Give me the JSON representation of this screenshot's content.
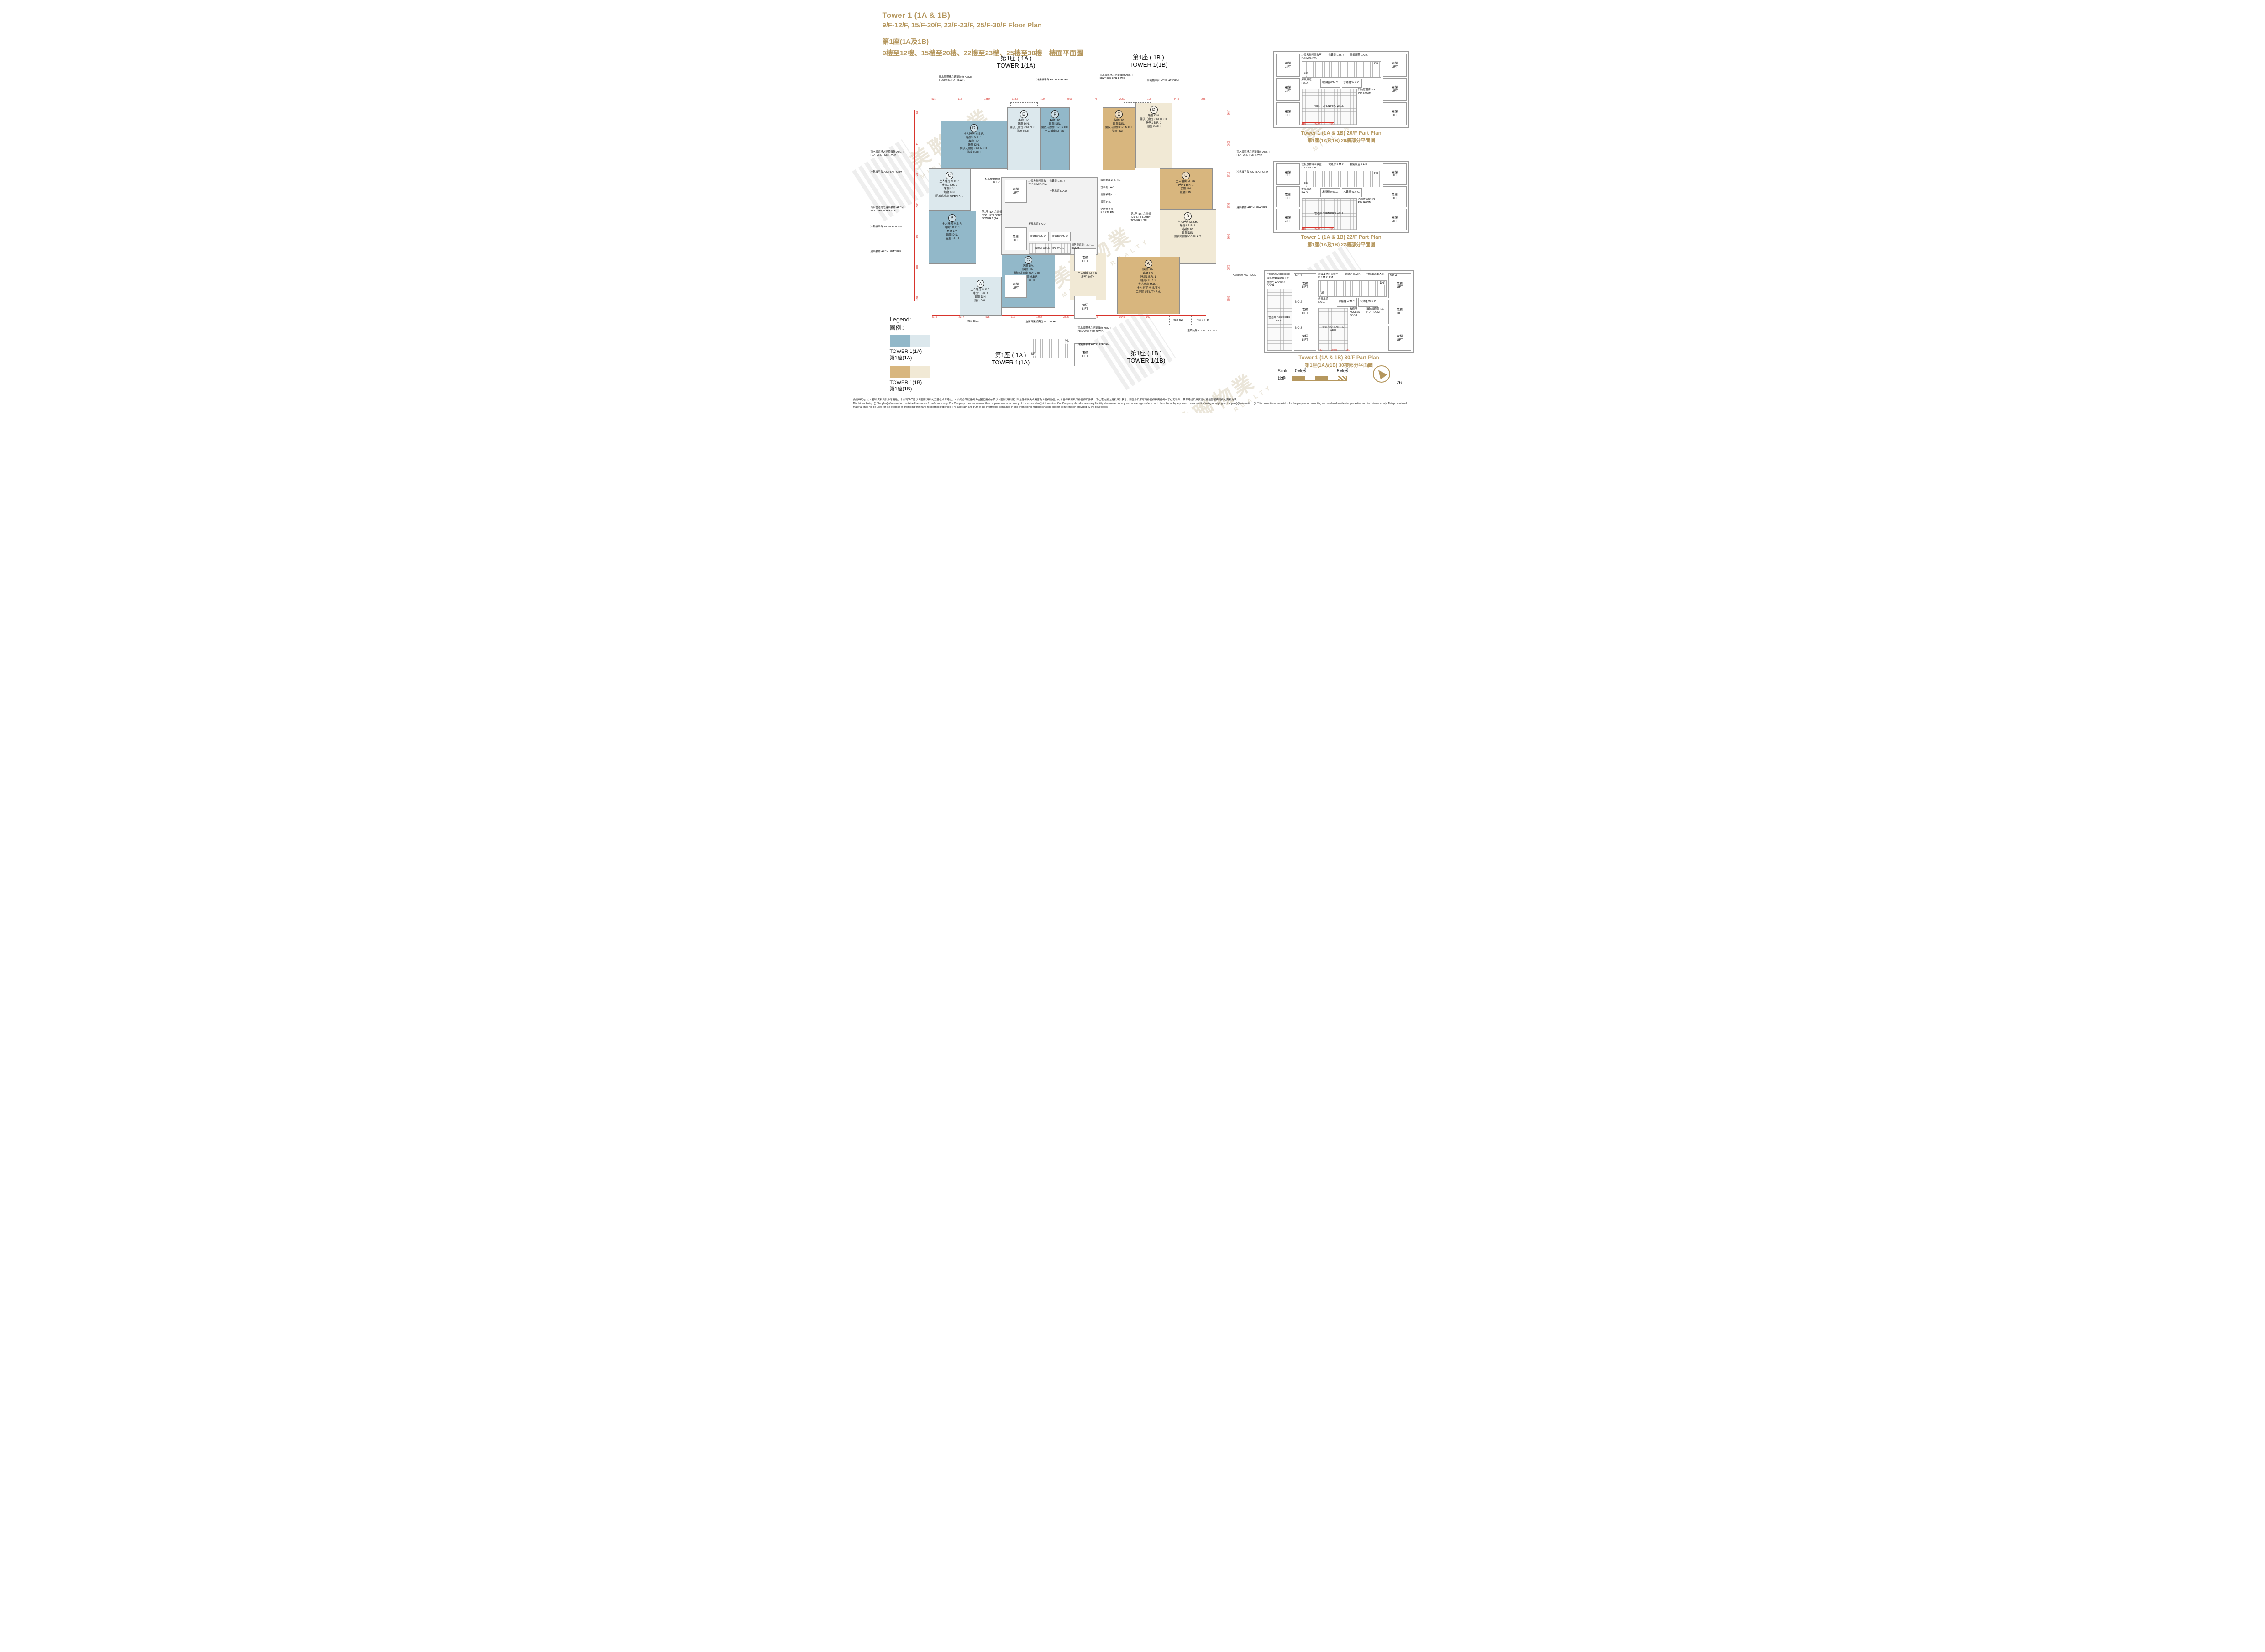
{
  "page": {
    "number": "26"
  },
  "header": {
    "en_line1": "Tower 1 (1A & 1B)",
    "en_line2": "9/F-12/F, 15/F-20/F, 22/F-23/F, 25/F-30/F   Floor Plan",
    "zh_line1": "第1座(1A及1B)",
    "zh_line2": "9樓至12樓、15樓至20樓、22樓至23樓、25樓至30樓　樓面平面圖"
  },
  "watermark": {
    "zh": "美聯物業",
    "en": "MIDLAND REALTY"
  },
  "tower_labels": {
    "t1a_zh": "第1座 ( 1A )",
    "t1a_en": "TOWER 1(1A)",
    "t1b_zh": "第1座 ( 1B )",
    "t1b_en": "TOWER 1(1B)"
  },
  "core": {
    "lift_zh": "電梯",
    "lift_en": "LIFT",
    "lobby_1a": "第1座 (1A) 之電梯大堂 LIFT LOBBY TOWER 1 (1A)",
    "lobby_1b": "第1座 (1B) 之電梯大堂 LIFT LOBBY TOWER 1 (1B)",
    "elv": "特低壓電線房 E.L.V.",
    "fad": "鮮風風道 F.A.D.",
    "rsmr": "垃圾及物料回收室 R.S.M.R. RM.",
    "emr": "電錶房 E.M.R.",
    "ead": "排氣風道 E.A.D.",
    "wmc": "水錶櫃 W.M.C.",
    "pipe_well": "管道井 OPEN PIPE WELL",
    "fspd_room": "消防管道房 F.S. P.D. ROOM",
    "fspd_rm": "消防管道房 F.S.P.D. RM.",
    "up": "UP",
    "dn": "DN",
    "trs": "臨時庇護處 T.R.S.",
    "lav": "洗手間 LAV.",
    "hr": "消防喉轆 H.R.",
    "pd": "管道 P.D.",
    "access_door": "檢修門 ACCESS DOOR",
    "ac_hood": "空調遮簷 A/C HOOD",
    "elv_short": "E.L.V."
  },
  "annotations": {
    "rwp": "雨水管道槽之建築裝飾 ARCH. FEATURE FOR R.W.P.",
    "acp": "冷氣機平台 A/C PLATFORM",
    "arch": "建築裝飾 ARCH. FEATURE",
    "ml": "金屬百葉於高位 M.L. AT H/L.",
    "bal": "露台 BAL.",
    "up_platform": "工作平台 U.P."
  },
  "units_1a": [
    {
      "letter": "D",
      "rooms": [
        "主人睡房 M.B.R.",
        "睡房1 B.R. 1",
        "客廳 LIV.",
        "飯廳 DIN.",
        "開放式廚房 OPEN KIT.",
        "浴室 BATH"
      ]
    },
    {
      "letter": "E",
      "rooms": [
        "客廳 LIV.",
        "飯廳 DIN.",
        "開放式廚房 OPEN KIT.",
        "浴室 BATH"
      ]
    },
    {
      "letter": "F",
      "rooms": [
        "客廳 LIV.",
        "飯廳 DIN.",
        "開放式廚房 OPEN KIT.",
        "主人睡房 M.B.R."
      ]
    },
    {
      "letter": "C",
      "rooms": [
        "主人睡房 M.B.R.",
        "睡房1 B.R. 1",
        "客廳 LIV.",
        "飯廳 DIN.",
        "開放式廚房 OPEN KIT."
      ]
    },
    {
      "letter": "B",
      "rooms": [
        "主人睡房 M.B.R.",
        "睡房1 B.R. 1",
        "客廳 LIV.",
        "飯廳 DIN.",
        "浴室 BATH"
      ]
    },
    {
      "letter": "G",
      "rooms": [
        "客廳 LIV.",
        "飯廳 DIN.",
        "開放式廚房 OPEN KIT.",
        "主人睡房 M.B.R.",
        "浴室 BATH"
      ]
    },
    {
      "letter": "A",
      "rooms": [
        "主人睡房 M.B.R.",
        "睡房1 B.R. 1",
        "飯廳 DIN.",
        "露台 BAL."
      ]
    }
  ],
  "units_1b": [
    {
      "letter": "E",
      "rooms": [
        "客廳 LIV.",
        "飯廳 DIN.",
        "開放式廚房 OPEN KIT.",
        "浴室 BATH"
      ]
    },
    {
      "letter": "D",
      "rooms": [
        "飯廳 DIN.",
        "開放式廚房 OPEN KIT.",
        "睡房1 B.R. 1",
        "浴室 BATH"
      ]
    },
    {
      "letter": "C",
      "rooms": [
        "主人睡房 M.B.R.",
        "睡房1 B.R. 1",
        "客廳 LIV.",
        "飯廳 DIN."
      ]
    },
    {
      "letter": "B",
      "rooms": [
        "主人睡房 M.B.R.",
        "睡房1 B.R. 1",
        "客廳 LIV.",
        "飯廳 DIN.",
        "開放式廚房 OPEN KIT."
      ]
    },
    {
      "letter": "F",
      "rooms": [
        "飯廳 DIN.",
        "睡房1 B.R. 1",
        "主人睡房 M.B.R.",
        "浴室 BATH"
      ]
    },
    {
      "letter": "A",
      "rooms": [
        "飯廳 DIN.",
        "客廳 LIV.",
        "睡房1 B.R. 1",
        "睡房2 B.R. 2",
        "主人睡房 M.B.R.",
        "主人浴室 M. BATH",
        "工作間 UTILITY RM."
      ]
    }
  ],
  "dimensions": {
    "top": [
      "535",
      "115",
      "1850",
      "123.5",
      "500",
      "2600",
      "75",
      "2050",
      "100",
      "4445",
      "295"
    ],
    "bottom": [
      "4145",
      "2347",
      "535",
      "115",
      "1350",
      "3815",
      "2443.5",
      "1645",
      "1074",
      "1956",
      "6990"
    ],
    "left": [
      "1495",
      "3945",
      "3025",
      "2050",
      "3600",
      "1805",
      "1660"
    ],
    "right": [
      "1495",
      "5080",
      "2725",
      "3025",
      "2495",
      "2240",
      "2815"
    ],
    "pp": [
      "440",
      "2400",
      "250"
    ]
  },
  "part_plans": [
    {
      "title_en": "Tower 1 (1A & 1B) 20/F Part Plan",
      "title_zh": "第1座(1A及1B) 20樓部分平面圖"
    },
    {
      "title_en": "Tower 1 (1A & 1B) 22/F Part Plan",
      "title_zh": "第1座(1A及1B) 22樓部分平面圖"
    },
    {
      "title_en": "Tower 1 (1A & 1B) 30/F Part Plan",
      "title_zh": "第1座(1A及1B) 30樓部分平面圖",
      "lift_nos": [
        "NO.1",
        "NO.2",
        "NO.3",
        "NO.4"
      ]
    }
  ],
  "legend": {
    "title_en": "Legend:",
    "title_zh": "圖例：",
    "items": [
      {
        "label_en": "TOWER 1(1A)",
        "label_zh": "第1座(1A)",
        "color_dark": "#92b8c9",
        "color_light": "#dce8ed"
      },
      {
        "label_en": "TOWER 1(1B)",
        "label_zh": "第1座(1B)",
        "color_dark": "#d8b67e",
        "color_light": "#f1e9d5"
      }
    ]
  },
  "scale_bar": {
    "label_en": "Scale :",
    "zero": "0M/米",
    "five": "5M/米",
    "label_zh": "比例"
  },
  "compass": {
    "north": "N"
  },
  "colors": {
    "gold": "#b5975e",
    "dimension_red": "#d8342c",
    "wall_gray": "#9a9a9a"
  },
  "disclaimer": {
    "zh": "免責聲明:(i)以上圖則/資料只供參考用途，本公司不保證以上圖則/資料的完整性或準確性。本公司亦不就任何人仕因使用或依賴以上圖則/資料所引致之任何損失或損害負上任何責任。(ii)本宣傳資料只可作宣傳及推廣二手住宅物業之用及只供參考，而並非及不可用作宣傳推廣任何一手住宅物業，其準確性及真實性以樓盤發展商提供的資料為準。",
    "en": "Disclaimer Policy: (i) The plan(s)/information contained herein are for reference only. Our Company does not warrant the completeness or accuracy of the above plan(s)/information. Our Company also disclaims any liability whatsoever for any loss or damage suffered or to be suffered by any person as a result of using or relying on the plan(s)/information. (ii) This promotional material is for the purpose of promoting second-hand residential properties and for reference only. This promotional material shall not be used for the purpose of promoting first-hand residential properties. The accuracy and truth of the information contained in this promotional material shall be subject to information provided by the developers."
  }
}
